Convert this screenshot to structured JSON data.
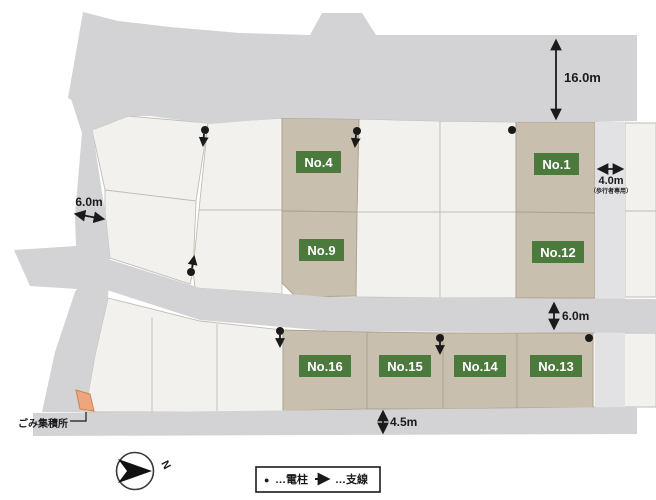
{
  "title": "区画図",
  "lots": [
    {
      "id": "no4",
      "label": "No.4"
    },
    {
      "id": "no1",
      "label": "No.1"
    },
    {
      "id": "no9",
      "label": "No.9"
    },
    {
      "id": "no12",
      "label": "No.12"
    },
    {
      "id": "no16",
      "label": "No.16"
    },
    {
      "id": "no15",
      "label": "No.15"
    },
    {
      "id": "no14",
      "label": "No.14"
    },
    {
      "id": "no13",
      "label": "No.13"
    }
  ],
  "dimensions": {
    "top_road_width": "16.0m",
    "left_road_width": "6.0m",
    "pedestrian_path_width": "4.0m",
    "pedestrian_path_note": "（歩行者専用）",
    "middle_road_width": "6.0m",
    "bottom_road_width": "4.5m"
  },
  "labels": {
    "trash_area": "ごみ集積所",
    "compass_north": "N"
  },
  "legend": {
    "pole_symbol": "●",
    "pole_label": "…電柱",
    "wire_label": "…支線"
  },
  "colors": {
    "road_gray": "#d3d3d6",
    "pedestrian_path_gray": "#e2e2e4",
    "lot_white": "#f2f1ee",
    "lot_highlight_tan": "#c8bfae",
    "lot_label_green": "#4c7a3d",
    "trash_orange": "#efa57d",
    "symbol_black": "#1a1a1a"
  }
}
